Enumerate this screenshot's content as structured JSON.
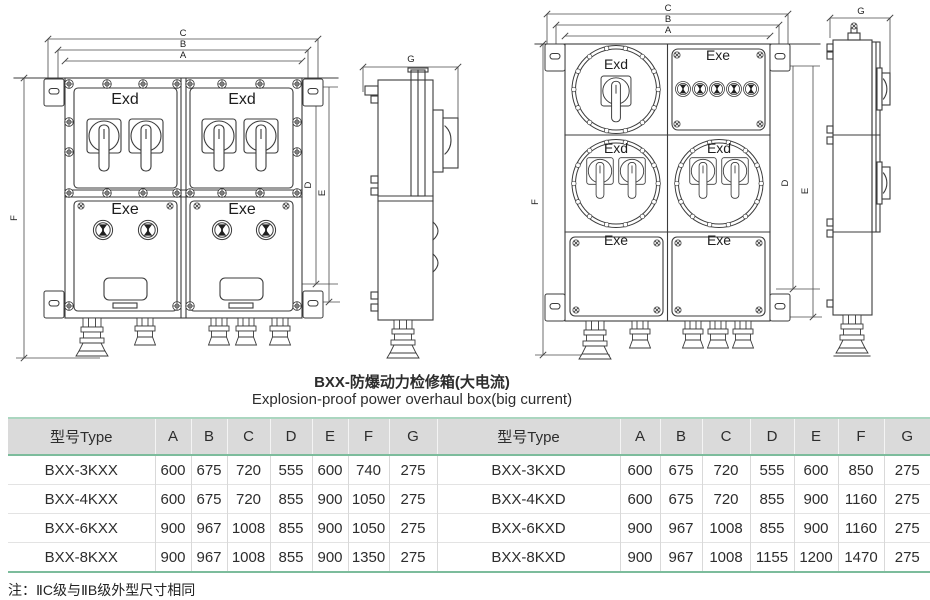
{
  "title": {
    "zh": "BXX-防爆动力检修箱(大电流)",
    "en": "Explosion-proof power overhaul box(big current)"
  },
  "labels": {
    "exd": "Exd",
    "exe": "Exe"
  },
  "dims": {
    "a": "A",
    "b": "B",
    "c": "C",
    "d": "D",
    "e": "E",
    "f": "F",
    "g": "G"
  },
  "table": {
    "type_header": "型号Type",
    "dim_headers": [
      "A",
      "B",
      "C",
      "D",
      "E",
      "F",
      "G"
    ],
    "left_rows": [
      {
        "type": "BXX-3KXX",
        "values": [
          "600",
          "675",
          "720",
          "555",
          "600",
          "740",
          "275"
        ]
      },
      {
        "type": "BXX-4KXX",
        "values": [
          "600",
          "675",
          "720",
          "855",
          "900",
          "1050",
          "275"
        ]
      },
      {
        "type": "BXX-6KXX",
        "values": [
          "900",
          "967",
          "1008",
          "855",
          "900",
          "1050",
          "275"
        ]
      },
      {
        "type": "BXX-8KXX",
        "values": [
          "900",
          "967",
          "1008",
          "855",
          "900",
          "1350",
          "275"
        ]
      }
    ],
    "right_rows": [
      {
        "type": "BXX-3KXD",
        "values": [
          "600",
          "675",
          "720",
          "555",
          "600",
          "850",
          "275"
        ]
      },
      {
        "type": "BXX-4KXD",
        "values": [
          "600",
          "675",
          "720",
          "855",
          "900",
          "1160",
          "275"
        ]
      },
      {
        "type": "BXX-6KXD",
        "values": [
          "900",
          "967",
          "1008",
          "855",
          "900",
          "1160",
          "275"
        ]
      },
      {
        "type": "BXX-8KXD",
        "values": [
          "900",
          "967",
          "1008",
          "1155",
          "1200",
          "1470",
          "275"
        ]
      }
    ]
  },
  "note": "注：ⅡC级与ⅡB级外型尺寸相同",
  "colors": {
    "table_green_strong": "#7cbc9c",
    "table_green_light": "#abd6c0",
    "header_gray": "#dadada",
    "line": "#3b3b3b"
  }
}
